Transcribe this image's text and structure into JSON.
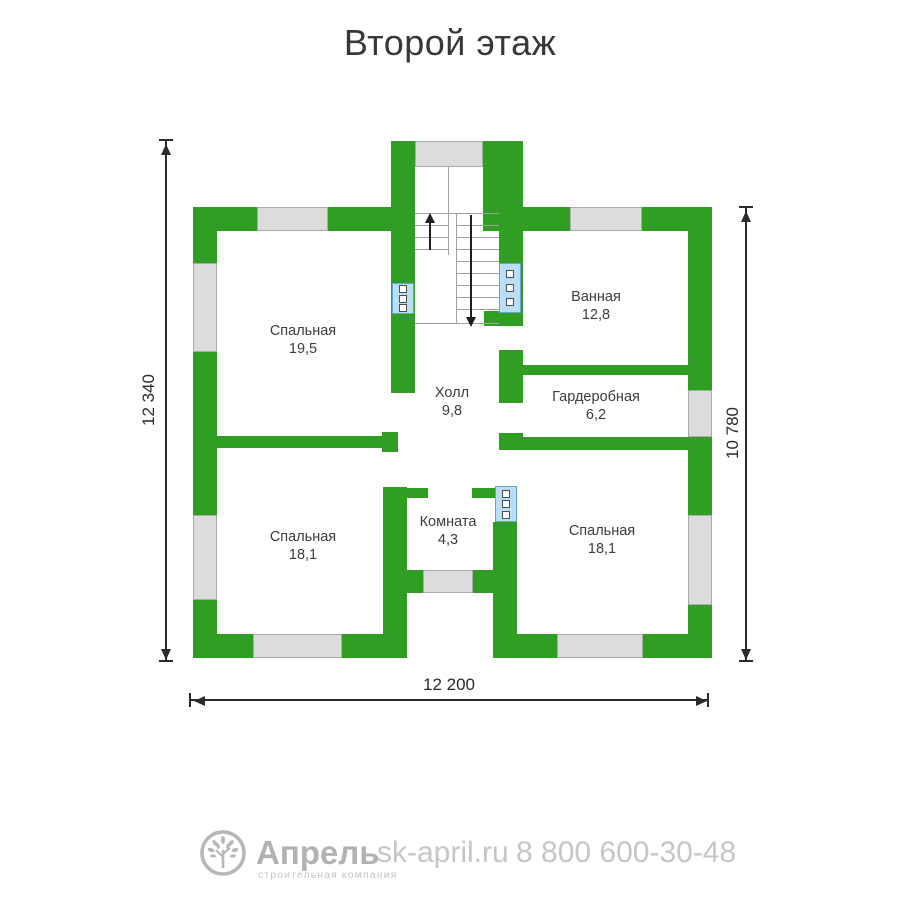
{
  "title": "Второй этаж",
  "floor_plan": {
    "rooms": [
      {
        "name": "Спальная",
        "area": "19,5"
      },
      {
        "name": "Ванная",
        "area": "12,8"
      },
      {
        "name": "Холл",
        "area": "9,8"
      },
      {
        "name": "Гардеробная",
        "area": "6,2"
      },
      {
        "name": "Спальная",
        "area": "18,1"
      },
      {
        "name": "Комната",
        "area": "4,3"
      },
      {
        "name": "Спальная",
        "area": "18,1"
      }
    ],
    "dimensions": {
      "left": "12 340",
      "right": "10 780",
      "bottom": "12 200"
    },
    "colors": {
      "wall": "#2f9e22",
      "window": "#dcdcdc",
      "radiator": "#badef7"
    }
  },
  "footer": {
    "brand": "Апрель",
    "tagline": "строительная компания",
    "website": "sk-april.ru",
    "phone": "8 800 600-30-48"
  }
}
